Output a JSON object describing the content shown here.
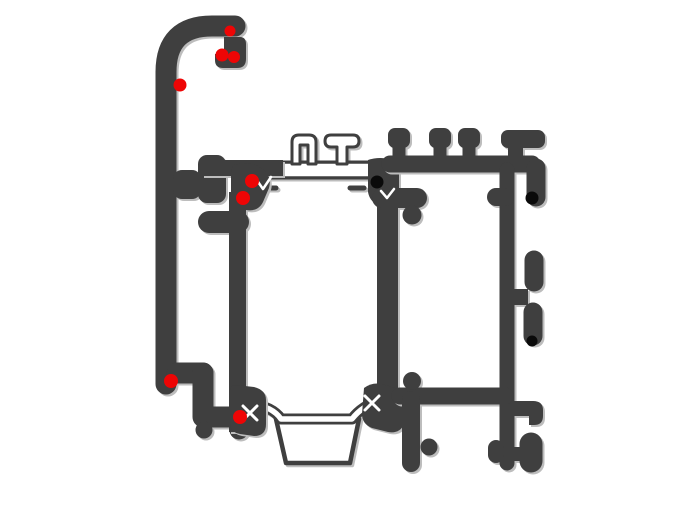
{
  "diagram": {
    "kind": "aluminium-profile-cross-section",
    "background": "#ffffff"
  },
  "colors": {
    "profile_dark": "#3f3f3f",
    "shadow_gray": "#bdbdbd",
    "thermal_break_fill": "#ffffff",
    "marker_red": "#ee0505",
    "marker_black": "#0a0a0a"
  },
  "markers": {
    "red": [
      {
        "x": 230,
        "y": 31,
        "r": 5.5
      },
      {
        "x": 222,
        "y": 55,
        "r": 6.5
      },
      {
        "x": 234,
        "y": 57,
        "r": 6
      },
      {
        "x": 180,
        "y": 85,
        "r": 6.5
      },
      {
        "x": 252,
        "y": 181,
        "r": 7
      },
      {
        "x": 243,
        "y": 198,
        "r": 7
      },
      {
        "x": 171,
        "y": 381,
        "r": 7
      },
      {
        "x": 240,
        "y": 417,
        "r": 7
      }
    ],
    "black": [
      {
        "x": 377,
        "y": 182,
        "r": 6.5
      },
      {
        "x": 532,
        "y": 198,
        "r": 6.5
      },
      {
        "x": 532,
        "y": 341,
        "r": 5.5
      }
    ]
  }
}
